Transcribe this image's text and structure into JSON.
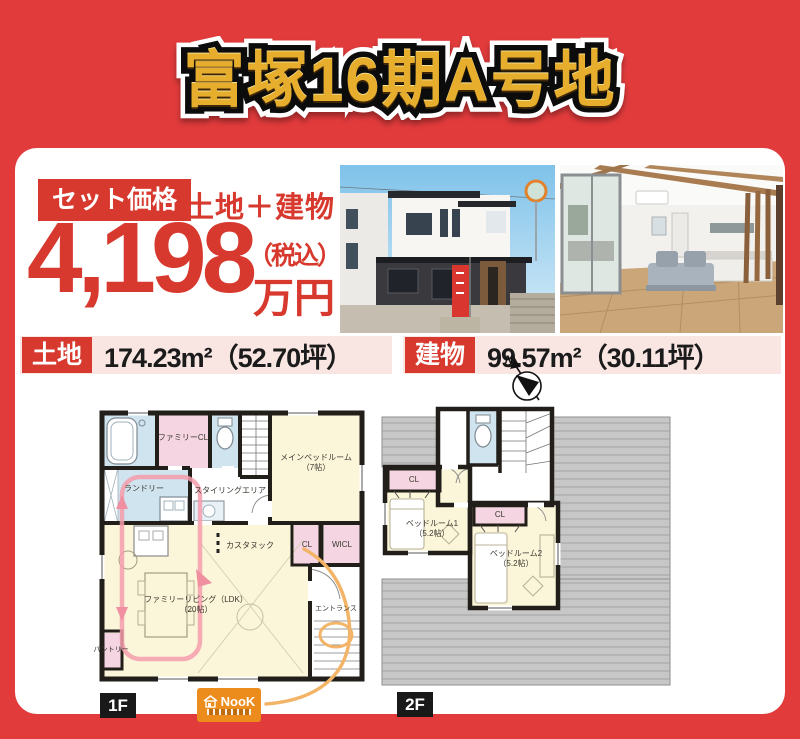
{
  "header": {
    "title": "富塚16期A号地"
  },
  "price": {
    "set_label": "セット価格",
    "combo_label": "土地＋建物",
    "amount": "4,198",
    "tax_note": "（税込）",
    "unit": "万円"
  },
  "area": {
    "land_label": "土地",
    "land_value": "174.23m²（52.70坪）",
    "building_label": "建物",
    "building_value": "99.57m²（30.11坪）"
  },
  "plans": {
    "compass": "N",
    "f1": {
      "tag": "1F",
      "labels": {
        "family_cl": "ファミリーCL",
        "laundry": "ランドリー",
        "styling": "スタイリングエリア",
        "main_bedroom": "メインベッドルーム",
        "main_bedroom_size": "（7帖）",
        "custom_nook": "カスタヌック",
        "cl": "CL",
        "wicl": "WICL",
        "living": "ファミリーリビング（LDK）",
        "living_size": "（20帖）",
        "entrance": "エントランス",
        "pantry": "パントリー"
      }
    },
    "f2": {
      "tag": "2F",
      "labels": {
        "cl1": "CL",
        "cl2": "CL",
        "bedroom1": "ベッドルーム1",
        "bedroom1_size": "（5.2帖）",
        "bedroom2": "ベッドルーム2",
        "bedroom2_size": "（5.2帖）"
      }
    }
  },
  "logo": {
    "text": "NooK"
  },
  "colors": {
    "page_red": "#e23b3c",
    "accent_red": "#d8392e",
    "gold": "#e7ad2d",
    "strip_pink": "#f9e6e2",
    "plan_cream": "#fbf5d9",
    "plan_pink": "#f5d5e1",
    "plan_blue": "#cfe4ef",
    "roof_gray": "#c7c7c7",
    "logo_orange": "#ec8c1c"
  }
}
